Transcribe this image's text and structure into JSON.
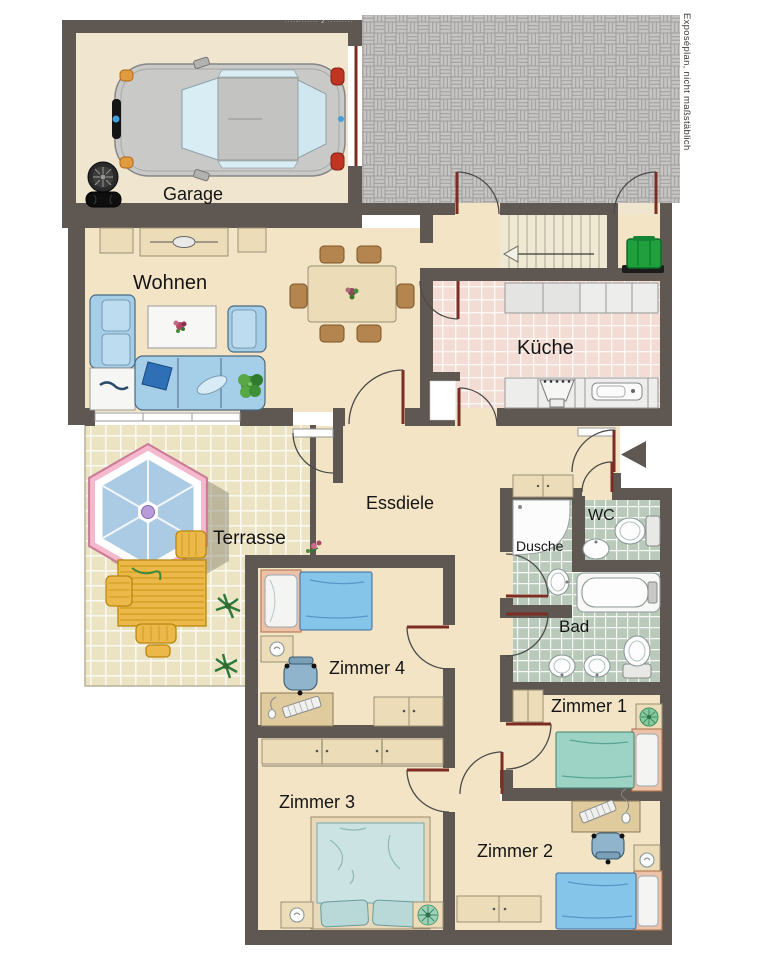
{
  "plan": {
    "rooms": {
      "garage": "Garage",
      "wohnen": "Wohnen",
      "kueche": "Küche",
      "essdiele": "Essdiele",
      "terrasse": "Terrasse",
      "dusche": "Dusche",
      "wc": "WC",
      "bad": "Bad",
      "zimmer1": "Zimmer 1",
      "zimmer2": "Zimmer 2",
      "zimmer3": "Zimmer 3",
      "zimmer4": "Zimmer 4"
    },
    "annotations": {
      "side_note": "Exposéplan, nicht maßstäblich",
      "watermark": "····-······· 2 ·········"
    },
    "colors": {
      "wall": "#5f5752",
      "floor": "#f4e4c6",
      "garage_floor": "#f0e6cf",
      "kitchen_tile": "#f2dcd3",
      "bath_tile": "#b9cabb",
      "terrace_tile": "#ebe3c2",
      "paver": "#c6c5c3",
      "door": "#7b2d23",
      "furniture": "#ecdcb8",
      "sofa_blue": "#a5cee9",
      "bed_blue": "#86c5ea",
      "bed_teal": "#9cd3c4",
      "chair_brown": "#b5854f",
      "table_yellow": "#edb84a",
      "umbrella_pink": "#f5b8cc",
      "umbrella_blue": "#abcbe4",
      "bin_green": "#1fa03c",
      "plant_green": "#4f9c45"
    }
  }
}
